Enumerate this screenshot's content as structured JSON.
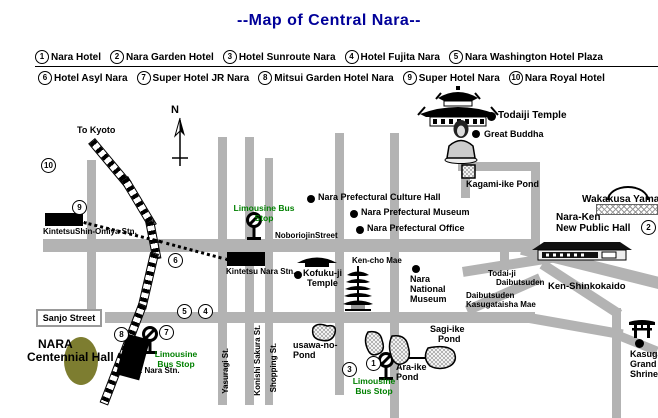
{
  "title": "--Map of Central Nara--",
  "colors": {
    "title_blue": "#000099",
    "road_gray": "#b3b3b3",
    "green_text": "#008000",
    "hall_olive": "#7d7d30"
  },
  "legend": {
    "row1": [
      {
        "num": "1",
        "label": "Nara Hotel"
      },
      {
        "num": "2",
        "label": "Nara Garden Hotel"
      },
      {
        "num": "3",
        "label": "Hotel Sunroute Nara"
      },
      {
        "num": "4",
        "label": "Hotel Fujita Nara"
      },
      {
        "num": "5",
        "label": "Nara Washington Hotel Plaza"
      }
    ],
    "row2": [
      {
        "num": "6",
        "label": "Hotel Asyl Nara"
      },
      {
        "num": "7",
        "label": "Super Hotel JR Nara"
      },
      {
        "num": "8",
        "label": "Mitsui Garden Hotel Nara"
      },
      {
        "num": "9",
        "label": "Super Hotel Nara"
      },
      {
        "num": "10",
        "label": "Nara Royal Hotel"
      }
    ]
  },
  "markers": {
    "m1": "1",
    "m2": "2",
    "m3": "3",
    "m4": "4",
    "m5": "5",
    "m6": "6",
    "m7": "7",
    "m8": "8",
    "m9": "9",
    "m10": "10"
  },
  "stations": {
    "shin_omiya": "KintetsuShin-Omiya Stn.",
    "kintetsu_nara": "Kintetsu Nara Stn.",
    "jr_nara": "JR Nara Stn."
  },
  "bus_stops": {
    "noborioji": {
      "line1": "Limousine Bus",
      "line2": "Stop"
    },
    "jr": {
      "line1": "Limousine",
      "line2": "Bus Stop"
    },
    "araike": {
      "line1": "Limousine",
      "line2": "Bus Stop"
    }
  },
  "streets": {
    "noborioji": "NoboriojinStreet",
    "sanjo": "Sanjo Street",
    "yasuragi": "Yasuragi St.",
    "konishi": "Konishi Sakura St.",
    "shopping": "Shopping St.",
    "ken_shinkokaido": "Ken-Shinkokaido"
  },
  "pois": {
    "north": "N",
    "to_kyoto": "To Kyoto",
    "pref_culture_hall": "Nara Prefectural Culture Hall",
    "pref_museum": "Nara Prefectural Museum",
    "pref_office": "Nara Prefectural Office",
    "todaiji": "Todaiji Temple",
    "great_buddha": "Great Buddha",
    "kagami_pond": "Kagami-ike Pond",
    "wakakusa": "Wakakusa Yama",
    "naraken_hall": {
      "line1": "Nara-Ken",
      "line2": "New Public Hall"
    },
    "kofukuji": {
      "line1": "Kofuku-ji",
      "line2": "Temple"
    },
    "kencho_mae": "Ken-cho Mae",
    "nara_national_museum": {
      "line1": "Nara",
      "line2": "National",
      "line3": "Museum"
    },
    "todaiji_daibutsuden": {
      "line1": "Todai-ji",
      "line2": "Daibutsuden"
    },
    "daibutsuden_kasugataisha": {
      "line1": "Daibutsuden",
      "line2": "Kasugataisha Mae"
    },
    "sagi_pond": {
      "line1": "Sagi-ike",
      "line2": "Pond"
    },
    "usawa_pond": {
      "line1": "usawa-no-",
      "line2": "Pond"
    },
    "ara_pond": {
      "line1": "Ara-ike",
      "line2": "Pond"
    },
    "kasuga": {
      "line1": "Kasuga",
      "line2": "Grand",
      "line3": "Shrine"
    },
    "centennial": {
      "line1": "NARA",
      "line2": "Centennial Hall"
    }
  }
}
